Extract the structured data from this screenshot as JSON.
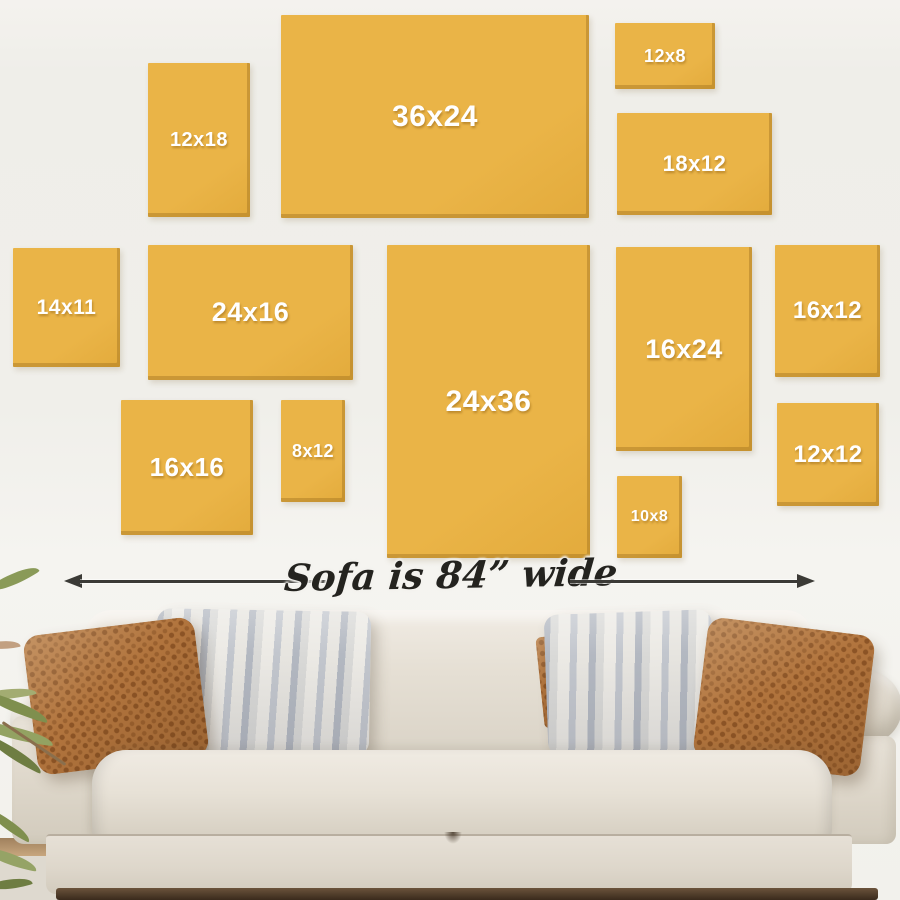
{
  "scene": {
    "wall_color": "#f0efea",
    "frame_color": "#eab447",
    "frame_shadow_color": "#b58d33",
    "frame_label_color": "#ffffff",
    "arrow_color": "#3b3a36",
    "dimension_text_color": "#24231f",
    "sofa_fabric_color": "#e7e1d7",
    "pillow_rust_color": "#b1743d",
    "pillow_stripe_color": "#b3b8c1",
    "floor_shadow_color": "#3a2a1c",
    "plant_leaf_color": "#83944f"
  },
  "frames": [
    {
      "label": "12x18",
      "x": 148,
      "y": 63,
      "w": 102,
      "h": 154,
      "font": 20
    },
    {
      "label": "36x24",
      "x": 281,
      "y": 15,
      "w": 308,
      "h": 203,
      "font": 30
    },
    {
      "label": "12x8",
      "x": 615,
      "y": 23,
      "w": 100,
      "h": 66,
      "font": 18
    },
    {
      "label": "18x12",
      "x": 617,
      "y": 113,
      "w": 155,
      "h": 102,
      "font": 22
    },
    {
      "label": "14x11",
      "x": 13,
      "y": 248,
      "w": 107,
      "h": 119,
      "font": 21
    },
    {
      "label": "24x16",
      "x": 148,
      "y": 245,
      "w": 205,
      "h": 135,
      "font": 27
    },
    {
      "label": "24x36",
      "x": 387,
      "y": 245,
      "w": 203,
      "h": 313,
      "font": 30
    },
    {
      "label": "16x24",
      "x": 616,
      "y": 247,
      "w": 136,
      "h": 204,
      "font": 27
    },
    {
      "label": "16x12",
      "x": 775,
      "y": 245,
      "w": 105,
      "h": 132,
      "font": 24
    },
    {
      "label": "16x16",
      "x": 121,
      "y": 400,
      "w": 132,
      "h": 135,
      "font": 26
    },
    {
      "label": "8x12",
      "x": 281,
      "y": 400,
      "w": 64,
      "h": 102,
      "font": 18
    },
    {
      "label": "12x12",
      "x": 777,
      "y": 403,
      "w": 102,
      "h": 103,
      "font": 24
    },
    {
      "label": "10x8",
      "x": 617,
      "y": 476,
      "w": 65,
      "h": 82,
      "font": 16
    }
  ],
  "dimension": {
    "label": "Sofa is 84” wide"
  }
}
